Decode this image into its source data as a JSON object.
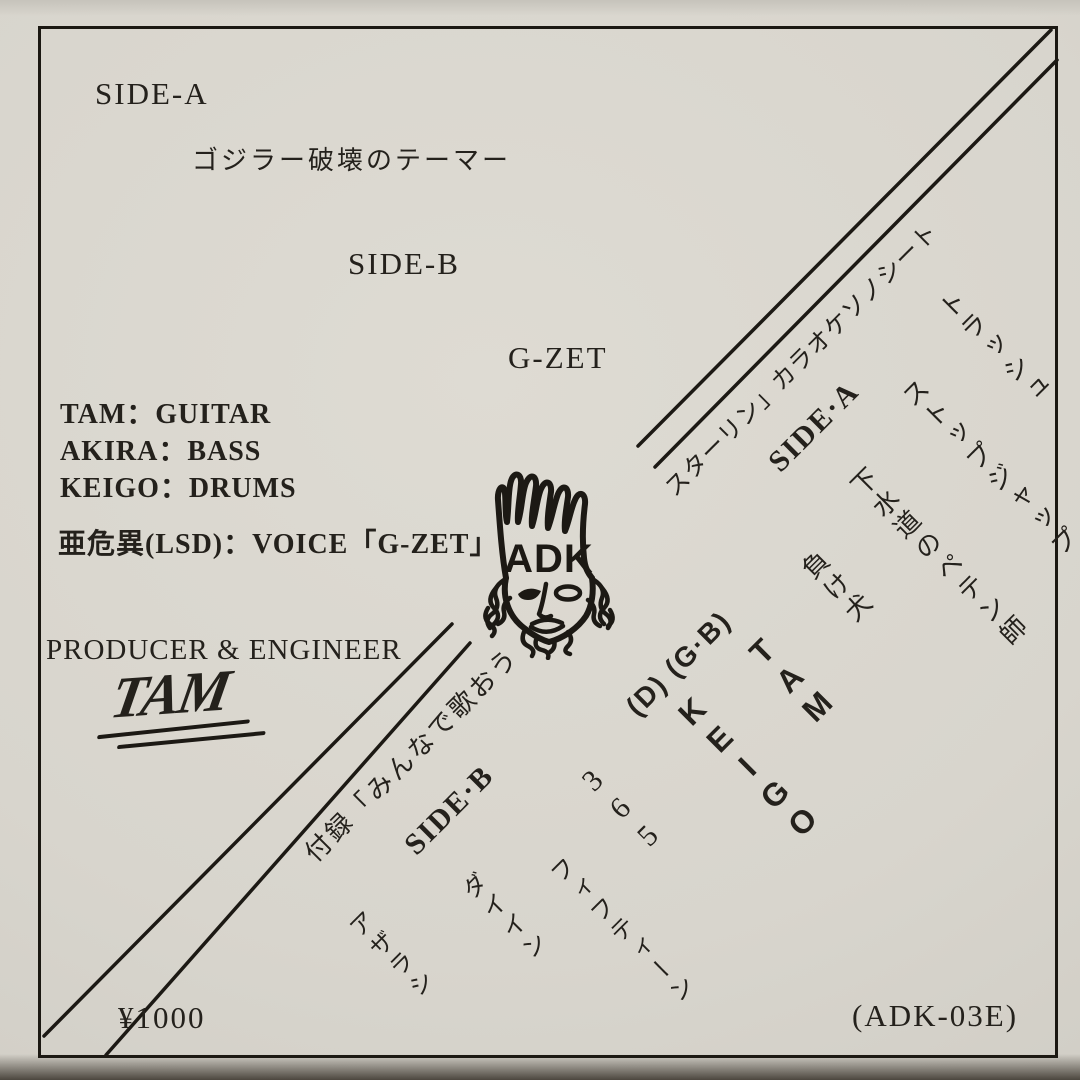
{
  "side_a": {
    "label": "SIDE-A",
    "track": "ゴジラー破壊のテーマー"
  },
  "side_b": {
    "label": "SIDE-B",
    "artist": "G-ZET"
  },
  "credits": {
    "guitar": "TAM：GUITAR",
    "bass": "AKIRA：BASS",
    "drums": "KEIGO：DRUMS",
    "voice": "亜危異(LSD)：VOICE「G-ZET」",
    "producer_title": "PRODUCER & ENGINEER",
    "producer_signature": "TAM"
  },
  "logo": {
    "text": "ADK"
  },
  "karaoke": {
    "header": "スターリン」カラオケソノシート",
    "side_a_label": "SIDE·A",
    "side_a_tracks": [
      "トラッシュ",
      "ストップジャップ",
      "下水道のペテン師",
      "負け犬"
    ],
    "appendix": "付録「みんなで歌おう",
    "side_b_label": "SIDE·B",
    "side_b_tracks": [
      "365",
      "フィフティーン",
      "ダイイン",
      "アザラシ"
    ],
    "musicians": {
      "instruments": "(D) (G·B)",
      "names": [
        "TAM",
        "KEIGO"
      ]
    }
  },
  "footer": {
    "price": "¥1000",
    "catalog": "(ADK-03E)"
  },
  "colors": {
    "ink": "#1c1914",
    "paper": "#d8d5cd"
  }
}
